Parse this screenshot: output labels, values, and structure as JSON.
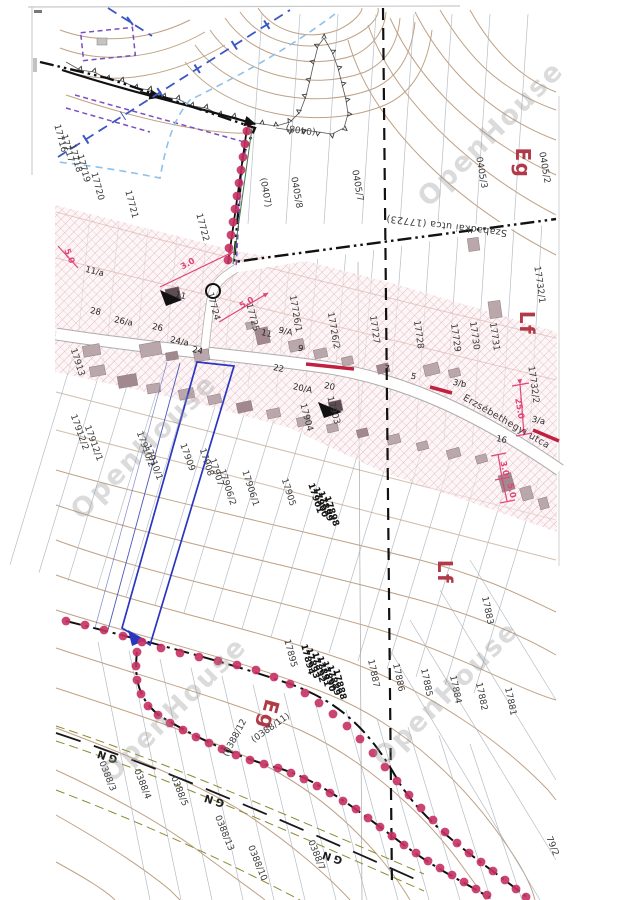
{
  "document_kind": "cadastral zoning map scan",
  "colors": {
    "zone_label_red": "#b23a48",
    "boundary_dot_magenta": "#c73062",
    "subject_parcel_blue": "#2a35c0",
    "hatch_pink": "#dd9fb2",
    "dimension_pink": "#e0457b",
    "contour_brown": "#b5916f",
    "road_red": "#c22040"
  },
  "dots": {
    "r": 4.4,
    "color": "#c73062",
    "chains": [
      [
        [
          247,
          131
        ],
        [
          245,
          144
        ],
        [
          243,
          157
        ],
        [
          241,
          170
        ],
        [
          239,
          183
        ],
        [
          237,
          196
        ],
        [
          235,
          209
        ],
        [
          233,
          222
        ],
        [
          231,
          235
        ],
        [
          229,
          248
        ],
        [
          228,
          260
        ]
      ],
      [
        [
          66,
          621
        ],
        [
          85,
          625
        ],
        [
          104,
          630
        ],
        [
          123,
          636
        ],
        [
          142,
          642
        ],
        [
          161,
          648
        ],
        [
          180,
          653
        ],
        [
          199,
          657
        ],
        [
          218,
          661
        ],
        [
          237,
          665
        ],
        [
          256,
          670
        ],
        [
          274,
          677
        ],
        [
          290,
          684
        ],
        [
          305,
          693
        ],
        [
          319,
          703
        ],
        [
          333,
          714
        ],
        [
          347,
          726
        ],
        [
          360,
          739
        ],
        [
          373,
          753
        ],
        [
          385,
          767
        ],
        [
          397,
          781
        ],
        [
          409,
          795
        ],
        [
          421,
          808
        ],
        [
          433,
          820
        ],
        [
          445,
          832
        ],
        [
          457,
          843
        ],
        [
          469,
          853
        ],
        [
          481,
          862
        ],
        [
          493,
          871
        ],
        [
          505,
          880
        ],
        [
          516,
          889
        ],
        [
          526,
          897
        ]
      ],
      [
        [
          137,
          652
        ],
        [
          136,
          666
        ],
        [
          137,
          680
        ],
        [
          141,
          694
        ],
        [
          148,
          706
        ],
        [
          158,
          715
        ],
        [
          170,
          723
        ],
        [
          183,
          730
        ],
        [
          196,
          737
        ],
        [
          209,
          743
        ],
        [
          222,
          749
        ],
        [
          236,
          755
        ],
        [
          250,
          760
        ],
        [
          264,
          764
        ],
        [
          278,
          768
        ],
        [
          291,
          773
        ],
        [
          304,
          779
        ],
        [
          317,
          786
        ],
        [
          330,
          793
        ],
        [
          343,
          801
        ],
        [
          356,
          809
        ],
        [
          368,
          818
        ],
        [
          380,
          827
        ],
        [
          392,
          836
        ],
        [
          404,
          845
        ],
        [
          416,
          853
        ],
        [
          428,
          861
        ],
        [
          440,
          868
        ],
        [
          452,
          875
        ],
        [
          464,
          882
        ],
        [
          476,
          889
        ],
        [
          487,
          895
        ]
      ]
    ]
  },
  "labels": {
    "zones": [
      {
        "t": "Eg",
        "x": 516,
        "y": 163,
        "r": 90
      },
      {
        "t": "Lf",
        "x": 520,
        "y": 323,
        "r": 90
      },
      {
        "t": "Lf",
        "x": 438,
        "y": 572,
        "r": 90
      },
      {
        "t": "Eg",
        "x": 262,
        "y": 713,
        "r": 105
      }
    ],
    "streets": [
      {
        "t": "Erzsébethegyi utca",
        "x": 505,
        "y": 424,
        "r": 30
      },
      {
        "t": "Szabadkai utca  (17723)",
        "x": 447,
        "y": 223,
        "r": 187
      }
    ],
    "parcels": [
      {
        "t": "0405/2",
        "x": 542,
        "y": 168,
        "r": 80
      },
      {
        "t": "0405/3",
        "x": 479,
        "y": 173,
        "r": 80
      },
      {
        "t": "0405/7",
        "x": 355,
        "y": 186,
        "r": 80
      },
      {
        "t": "0405/8",
        "x": 294,
        "y": 193,
        "r": 80
      },
      {
        "t": "(0407)",
        "x": 263,
        "y": 193,
        "r": 80
      },
      {
        "t": "(0408)",
        "x": 301,
        "y": 127,
        "r": 188
      },
      {
        "t": "17716",
        "x": 58,
        "y": 139,
        "r": 75
      },
      {
        "t": "17717",
        "x": 65,
        "y": 149,
        "r": 75
      },
      {
        "t": "17718",
        "x": 73,
        "y": 159,
        "r": 75
      },
      {
        "t": "17719",
        "x": 81,
        "y": 169,
        "r": 75
      },
      {
        "t": "17720",
        "x": 95,
        "y": 187,
        "r": 75
      },
      {
        "t": "17721",
        "x": 129,
        "y": 205,
        "r": 75
      },
      {
        "t": "17722",
        "x": 200,
        "y": 228,
        "r": 75
      },
      {
        "t": "17724",
        "x": 211,
        "y": 307,
        "r": 75
      },
      {
        "t": "17725",
        "x": 250,
        "y": 318,
        "r": 75
      },
      {
        "t": "17726/1",
        "x": 293,
        "y": 314,
        "r": 80
      },
      {
        "t": "17726/2",
        "x": 331,
        "y": 331,
        "r": 80
      },
      {
        "t": "17727",
        "x": 372,
        "y": 330,
        "r": 82
      },
      {
        "t": "17728",
        "x": 416,
        "y": 335,
        "r": 82
      },
      {
        "t": "17729",
        "x": 453,
        "y": 338,
        "r": 82
      },
      {
        "t": "17730",
        "x": 472,
        "y": 336,
        "r": 82
      },
      {
        "t": "17731",
        "x": 492,
        "y": 337,
        "r": 82
      },
      {
        "t": "17732/1",
        "x": 537,
        "y": 285,
        "r": 82
      },
      {
        "t": "17732/2",
        "x": 531,
        "y": 385,
        "r": 82
      },
      {
        "t": "17913",
        "x": 75,
        "y": 363,
        "r": 72
      },
      {
        "t": "17912/2",
        "x": 77,
        "y": 433,
        "r": 70
      },
      {
        "t": "17912/1",
        "x": 91,
        "y": 444,
        "r": 70
      },
      {
        "t": "17910/2",
        "x": 143,
        "y": 450,
        "r": 70
      },
      {
        "t": "17910/1",
        "x": 151,
        "y": 463,
        "r": 70
      },
      {
        "t": "17909",
        "x": 185,
        "y": 458,
        "r": 70
      },
      {
        "t": "17908",
        "x": 204,
        "y": 463,
        "r": 72
      },
      {
        "t": "17907",
        "x": 214,
        "y": 473,
        "r": 72
      },
      {
        "t": "17906/2",
        "x": 225,
        "y": 488,
        "r": 72
      },
      {
        "t": "17906/1",
        "x": 248,
        "y": 489,
        "r": 72
      },
      {
        "t": "17905",
        "x": 286,
        "y": 493,
        "r": 72
      },
      {
        "t": "17904",
        "x": 304,
        "y": 418,
        "r": 75
      },
      {
        "t": "17903",
        "x": 331,
        "y": 411,
        "r": 75
      },
      {
        "t": "17901",
        "x": 313,
        "y": 499,
        "r": 72,
        "b": 1
      },
      {
        "t": "17900",
        "x": 318,
        "y": 503,
        "r": 72,
        "b": 1
      },
      {
        "t": "17899",
        "x": 323,
        "y": 507,
        "r": 72,
        "b": 1
      },
      {
        "t": "17898",
        "x": 329,
        "y": 512,
        "r": 72,
        "b": 1
      },
      {
        "t": "17895",
        "x": 288,
        "y": 654,
        "r": 75
      },
      {
        "t": "17894",
        "x": 305,
        "y": 660,
        "r": 75,
        "b": 1
      },
      {
        "t": "17893",
        "x": 310,
        "y": 664,
        "r": 75,
        "b": 1
      },
      {
        "t": "17892",
        "x": 316,
        "y": 668,
        "r": 75,
        "b": 1
      },
      {
        "t": "17891",
        "x": 321,
        "y": 672,
        "r": 75,
        "b": 1
      },
      {
        "t": "17890",
        "x": 326,
        "y": 677,
        "r": 75,
        "b": 1
      },
      {
        "t": "17889",
        "x": 331,
        "y": 681,
        "r": 75,
        "b": 1
      },
      {
        "t": "17888",
        "x": 337,
        "y": 685,
        "r": 75,
        "b": 1
      },
      {
        "t": "17887",
        "x": 371,
        "y": 674,
        "r": 78
      },
      {
        "t": "17886",
        "x": 396,
        "y": 678,
        "r": 78
      },
      {
        "t": "17885",
        "x": 424,
        "y": 683,
        "r": 78
      },
      {
        "t": "17884",
        "x": 453,
        "y": 690,
        "r": 78
      },
      {
        "t": "17883",
        "x": 485,
        "y": 611,
        "r": 78
      },
      {
        "t": "17882",
        "x": 479,
        "y": 697,
        "r": 78
      },
      {
        "t": "17881",
        "x": 508,
        "y": 702,
        "r": 78
      },
      {
        "t": "(0388/11)",
        "x": 272,
        "y": 730,
        "r": -35
      },
      {
        "t": "(0388/12",
        "x": 237,
        "y": 739,
        "r": -62
      },
      {
        "t": "0388/3",
        "x": 105,
        "y": 777,
        "r": 68
      },
      {
        "t": "0388/4",
        "x": 140,
        "y": 785,
        "r": 68
      },
      {
        "t": "0388/5",
        "x": 177,
        "y": 792,
        "r": 68
      },
      {
        "t": "0388/13",
        "x": 222,
        "y": 834,
        "r": 68
      },
      {
        "t": "0388/10",
        "x": 255,
        "y": 864,
        "r": 68
      },
      {
        "t": "0388/7",
        "x": 314,
        "y": 856,
        "r": 68
      },
      {
        "t": "79/2",
        "x": 550,
        "y": 847,
        "r": 68
      }
    ],
    "houses": [
      {
        "t": "11/a",
        "x": 94,
        "y": 274,
        "r": 14
      },
      {
        "t": "11",
        "x": 180,
        "y": 298,
        "r": 14
      },
      {
        "t": "28",
        "x": 95,
        "y": 314,
        "r": 12
      },
      {
        "t": "26/a",
        "x": 123,
        "y": 324,
        "r": 12
      },
      {
        "t": "26",
        "x": 157,
        "y": 330,
        "r": 12
      },
      {
        "t": "24/a",
        "x": 179,
        "y": 344,
        "r": 12
      },
      {
        "t": "24",
        "x": 197,
        "y": 353,
        "r": 12
      },
      {
        "t": "11",
        "x": 266,
        "y": 336,
        "r": 12
      },
      {
        "t": "9/A",
        "x": 285,
        "y": 334,
        "r": 12
      },
      {
        "t": "9",
        "x": 300,
        "y": 351,
        "r": 12
      },
      {
        "t": "22",
        "x": 278,
        "y": 371,
        "r": 12
      },
      {
        "t": "20/A",
        "x": 302,
        "y": 391,
        "r": 12
      },
      {
        "t": "20",
        "x": 329,
        "y": 389,
        "r": 12
      },
      {
        "t": "7",
        "x": 386,
        "y": 371,
        "r": 12
      },
      {
        "t": "5",
        "x": 413,
        "y": 379,
        "r": 12
      },
      {
        "t": "3/b",
        "x": 459,
        "y": 386,
        "r": 12
      },
      {
        "t": "3/a",
        "x": 538,
        "y": 423,
        "r": 12
      },
      {
        "t": "16",
        "x": 501,
        "y": 442,
        "r": 12
      }
    ],
    "dims": [
      {
        "t": "3.0",
        "x": 189,
        "y": 266,
        "r": -30
      },
      {
        "t": "5.0",
        "x": 248,
        "y": 305,
        "r": -30
      },
      {
        "t": "5.0",
        "x": 67,
        "y": 257,
        "r": 68
      },
      {
        "t": "25.0",
        "x": 517,
        "y": 409,
        "r": 80
      },
      {
        "t": "3.0",
        "x": 502,
        "y": 469,
        "r": 78
      },
      {
        "t": "5.0",
        "x": 509,
        "y": 491,
        "r": 78
      }
    ],
    "gn_marks": [
      {
        "t": "GN",
        "x": 107,
        "y": 753,
        "r": 198
      },
      {
        "t": "GN",
        "x": 214,
        "y": 797,
        "r": 198
      },
      {
        "t": "GN",
        "x": 332,
        "y": 854,
        "r": 198
      }
    ],
    "watermarks": [
      {
        "t": "OpenHouse",
        "x": 497,
        "y": 140,
        "r": -45
      },
      {
        "t": "OpenHouse",
        "x": 150,
        "y": 453,
        "r": -45
      },
      {
        "t": "OpenHouse",
        "x": 180,
        "y": 716,
        "r": -45
      },
      {
        "t": "OpenHouse",
        "x": 452,
        "y": 700,
        "r": -45
      }
    ]
  }
}
